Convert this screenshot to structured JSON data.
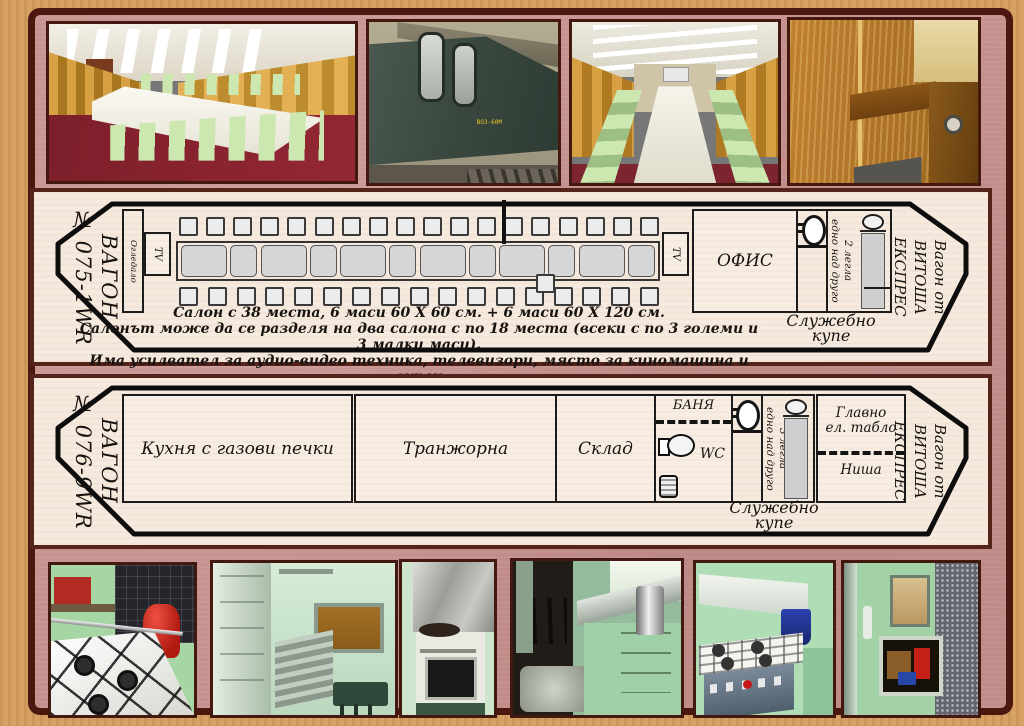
{
  "colors": {
    "frame-tan": "#d7a164",
    "frame-line": "#4b170e",
    "page-pink": "#c5908d",
    "panel-bg": "#f6eade",
    "panel-border": "#54231a",
    "photo-border": "#43180f",
    "ink": "#161310",
    "seat-fill": "#ececec",
    "table-fill": "#d6d6d6",
    "curtain-gold": "#d7a143",
    "carpet-red": "#87222c",
    "chair-green": "#cde7b0",
    "train-green": "#3f4e44",
    "kitchen-green": "#a6d6a4",
    "stove-white": "#f4f5ef"
  },
  "wagon1": {
    "number_label": {
      "line1": "ВАГОН",
      "line2": "№ 075-1WR"
    },
    "mirror": "Огледало",
    "tv": "TV",
    "office": "ОФИС",
    "beds": {
      "line1": "2 легла",
      "line2": "едно над друго"
    },
    "service": {
      "line1": "Служебно",
      "line2": "купе"
    },
    "brand": {
      "line1": "Вагон от",
      "line2": "ВИТОША",
      "line3": "ЕКСПРЕС"
    },
    "captions": [
      "Салон  с 38 места,  6 маси 60 Х 60 см.   +   6 маси 60 Х 120 см.",
      "Салонът може да се разделя на два салона с по 18 места (всеки с по 3 големи и 3 малки маси).",
      "Има усилвател за аудио-видео техника, телевизори, място за киномашина и екран"
    ],
    "layout": {
      "seats_top": 18,
      "seats_bottom": 17,
      "tables": 12,
      "total_seats": 38
    }
  },
  "wagon2": {
    "number_label": {
      "line1": "ВАГОН",
      "line2": "№ 076-9WR"
    },
    "rooms": {
      "kitchen": "Кухня с газови печки",
      "carving": "Транжорна",
      "storage": "Склад",
      "bath": "БАНЯ",
      "wc": "WC",
      "main_panel_line1": "Главно",
      "main_panel_line2": "ел. табло",
      "niche": "Ниша"
    },
    "beds": {
      "line1": "3 легла",
      "line2": "едно над друго"
    },
    "service": {
      "line1": "Служебно",
      "line2": "купе"
    },
    "brand": {
      "line1": "Вагон от",
      "line2": "ВИТОША",
      "line3": "ЕКСПРЕС"
    }
  },
  "photos": {
    "wagon_marking": "ВОЗ-60М",
    "top": [
      "dining-salon-side-view",
      "green-wagon-exterior",
      "dining-salon-front-view",
      "wood-paneled-compartment"
    ],
    "bottom": [
      "gas-stove-top-with-red-cylinder",
      "kitchen-window-and-bench",
      "stove-with-oven",
      "kitchen-counter-with-urn",
      "stove-with-hood-and-bucket",
      "kitchen-phone-niche"
    ]
  }
}
